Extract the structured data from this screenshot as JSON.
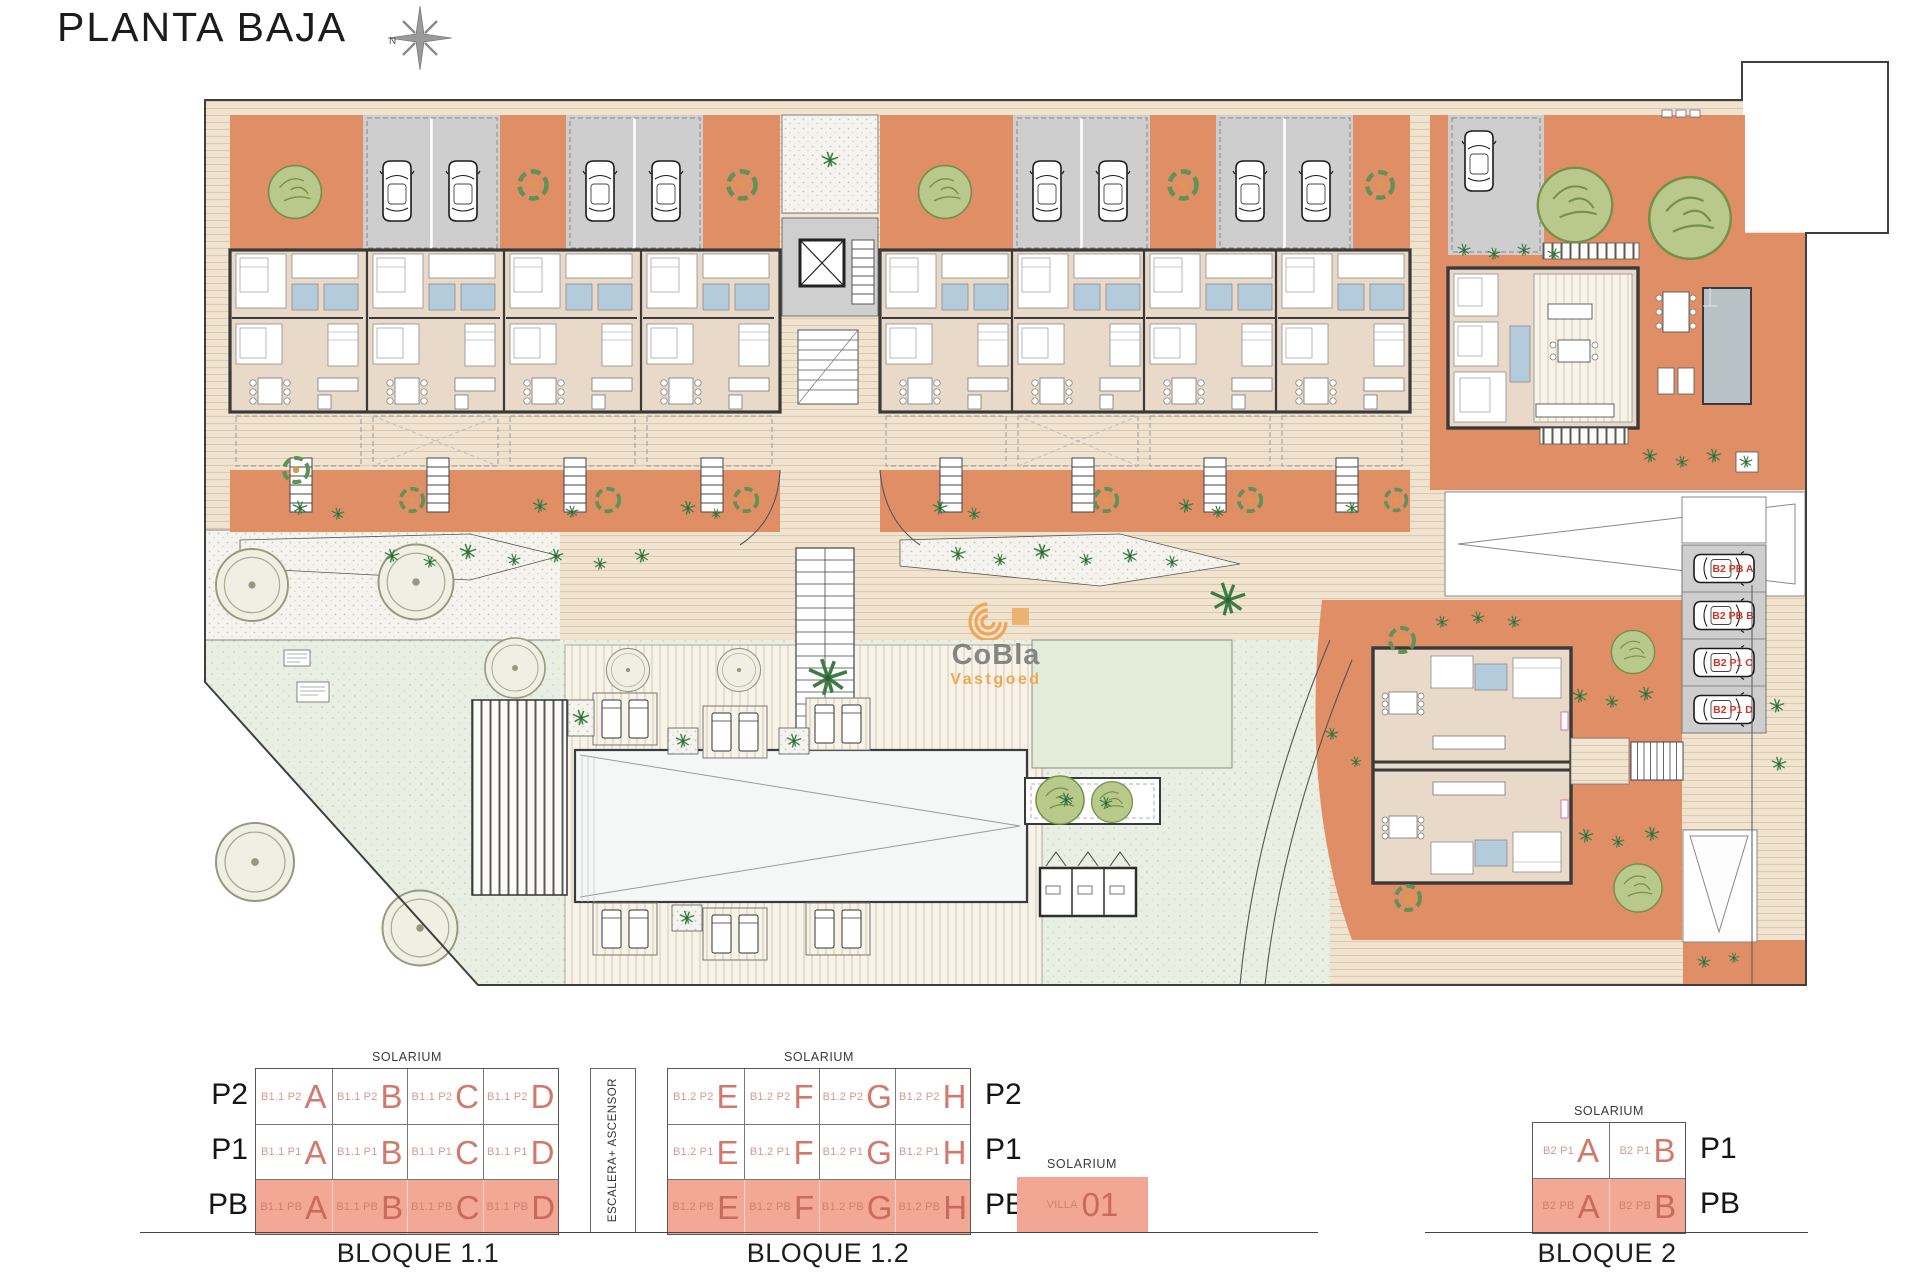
{
  "title": "PLANTA BAJA",
  "compass": {
    "north": "N"
  },
  "watermark": {
    "name": "CoBla",
    "sub": "Vastgoed",
    "accent": "#f0a14b",
    "text_color": "#7d7d7d"
  },
  "plan": {
    "parking_labels": [
      "B2 PB A",
      "B2 PB B",
      "B2 P1 C",
      "B2 P1 D"
    ],
    "colors": {
      "garden_orange": "#e08e66",
      "building_beige": "#e8d9c9",
      "walkway": "#f0e4d0",
      "parking_gray": "#cecece",
      "lawn_green": "#e9efe2",
      "bathroom_blue": "#b3cbdb",
      "wall": "#3a3a3a",
      "highlight_salmon": "#f3a895",
      "unit_letter_red": "#d3796c"
    }
  },
  "legend": {
    "solarium": "SOLARIUM",
    "escalera": "ESCALERA+ ASCENSOR",
    "floors_left": [
      "P2",
      "P1",
      "PB"
    ],
    "floors_right": [
      "P2",
      "P1",
      "PB"
    ],
    "b2_floors": [
      "P1",
      "PB"
    ],
    "villa": {
      "label": "VILLA",
      "number": "01"
    },
    "b11": {
      "name": "BLOQUE 1.1",
      "rows": [
        {
          "floor": "P2",
          "cells": [
            {
              "prefix": "B1.1 P2",
              "letter": "A"
            },
            {
              "prefix": "B1.1 P2",
              "letter": "B"
            },
            {
              "prefix": "B1.1 P2",
              "letter": "C"
            },
            {
              "prefix": "B1.1 P2",
              "letter": "D"
            }
          ]
        },
        {
          "floor": "P1",
          "cells": [
            {
              "prefix": "B1.1 P1",
              "letter": "A"
            },
            {
              "prefix": "B1.1 P1",
              "letter": "B"
            },
            {
              "prefix": "B1.1 P1",
              "letter": "C"
            },
            {
              "prefix": "B1.1 P1",
              "letter": "D"
            }
          ]
        },
        {
          "floor": "PB",
          "cells": [
            {
              "prefix": "B1.1 PB",
              "letter": "A"
            },
            {
              "prefix": "B1.1 PB",
              "letter": "B"
            },
            {
              "prefix": "B1.1 PB",
              "letter": "C"
            },
            {
              "prefix": "B1.1 PB",
              "letter": "D"
            }
          ]
        }
      ]
    },
    "b12": {
      "name": "BLOQUE 1.2",
      "rows": [
        {
          "floor": "P2",
          "cells": [
            {
              "prefix": "B1.2 P2",
              "letter": "E"
            },
            {
              "prefix": "B1.2 P2",
              "letter": "F"
            },
            {
              "prefix": "B1.2 P2",
              "letter": "G"
            },
            {
              "prefix": "B1.2 P2",
              "letter": "H"
            }
          ]
        },
        {
          "floor": "P1",
          "cells": [
            {
              "prefix": "B1.2 P1",
              "letter": "E"
            },
            {
              "prefix": "B1.2 P1",
              "letter": "F"
            },
            {
              "prefix": "B1.2 P1",
              "letter": "G"
            },
            {
              "prefix": "B1.2 P1",
              "letter": "H"
            }
          ]
        },
        {
          "floor": "PB",
          "cells": [
            {
              "prefix": "B1.2 PB",
              "letter": "E"
            },
            {
              "prefix": "B1.2 PB",
              "letter": "F"
            },
            {
              "prefix": "B1.2 PB",
              "letter": "G"
            },
            {
              "prefix": "B1.2 PB",
              "letter": "H"
            }
          ]
        }
      ]
    },
    "b2": {
      "name": "BLOQUE 2",
      "rows": [
        {
          "floor": "P1",
          "cells": [
            {
              "prefix": "B2 P1",
              "letter": "A"
            },
            {
              "prefix": "B2 P1",
              "letter": "B"
            }
          ]
        },
        {
          "floor": "PB",
          "cells": [
            {
              "prefix": "B2 PB",
              "letter": "A"
            },
            {
              "prefix": "B2 PB",
              "letter": "B"
            }
          ]
        }
      ]
    }
  }
}
